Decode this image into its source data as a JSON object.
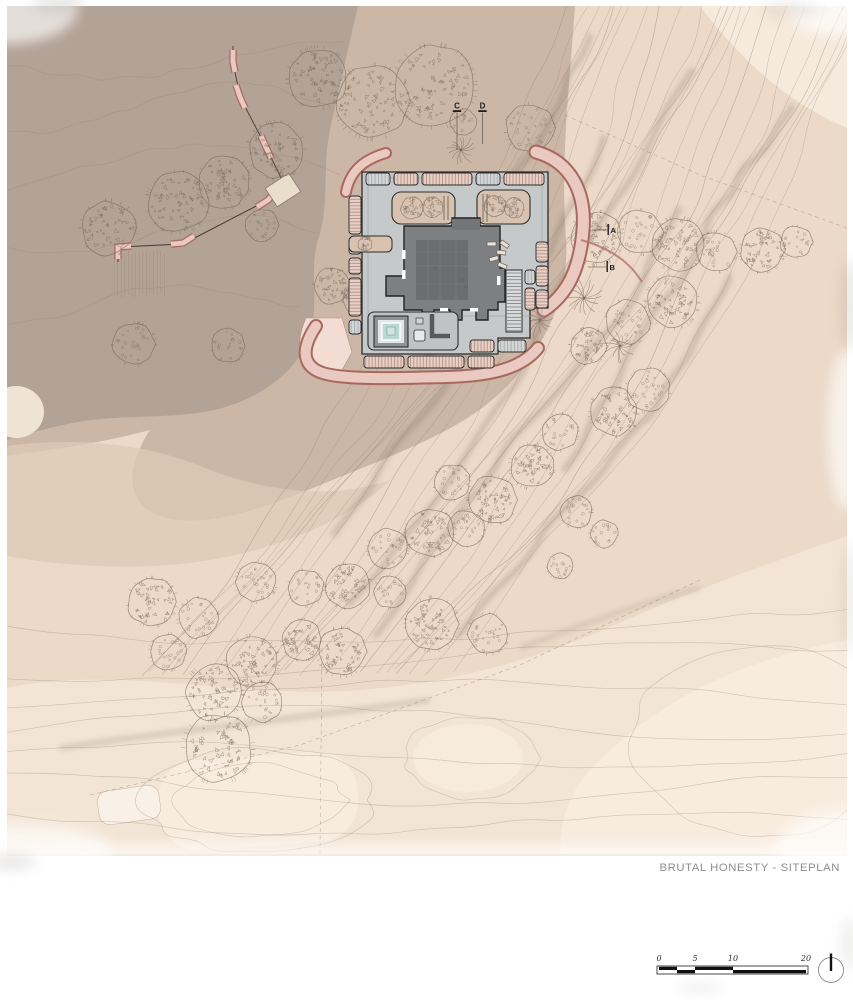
{
  "title": {
    "text": "BRUTAL HONESTY - SITEPLAN"
  },
  "section_markers": {
    "c": "C",
    "d": "D",
    "a": "A",
    "b": "B"
  },
  "scale_bar": {
    "labels": [
      "0",
      "5",
      "10",
      "20"
    ]
  },
  "colors": {
    "paper": "#ffffff",
    "terrain_base": "#ecd9c7",
    "terrain_light": "#f3e5d5",
    "terrain_lighter": "#f8ecdf",
    "plateau": "#b3a296",
    "midtone": "#ccb7a6",
    "midtone_light": "#dcc9b6",
    "contour": "#9b8a7b",
    "relief": "#61534a",
    "path_pink": "#eac9c0",
    "path_pink_light": "#f3dcd4",
    "path_outline": "#a8685f",
    "terrace": "#c6c9ca",
    "terrace_light": "#d6d9d9",
    "roof": "#7d7f81",
    "roof_dark": "#6b6d6f",
    "outline": "#2c2c2c",
    "pool": "#b9d8d2",
    "courtyard": "#d9c3b0",
    "planter_pink": "#e2c6bb",
    "tree": "#75675a",
    "title_color": "#8d8d8d",
    "marker_color": "#1e1e1e"
  }
}
